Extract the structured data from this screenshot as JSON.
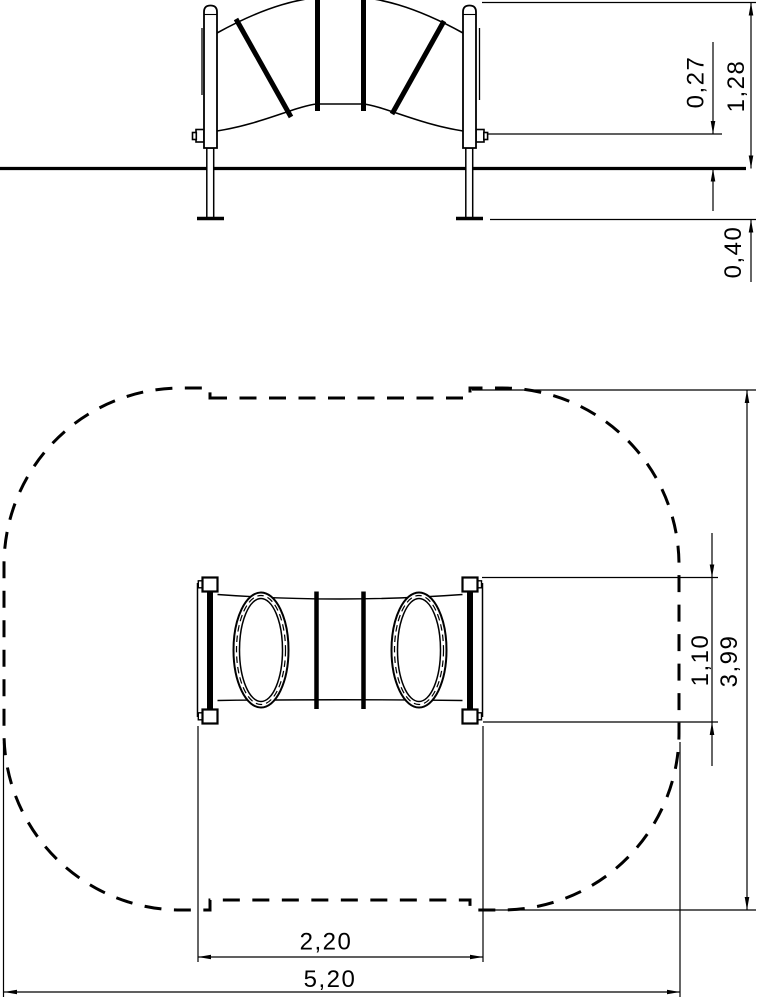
{
  "drawing": {
    "background_color": "#ffffff",
    "line_color": "#000000",
    "elevation_view": {
      "dimensions": {
        "net_rise": "0,27",
        "total_height": "1,28",
        "foundation_depth": "0,40"
      }
    },
    "plan_view": {
      "dimensions": {
        "frame_width": "1,10",
        "safety_zone_width": "3,99",
        "frame_length": "2,20",
        "safety_zone_length": "5,20"
      }
    }
  }
}
